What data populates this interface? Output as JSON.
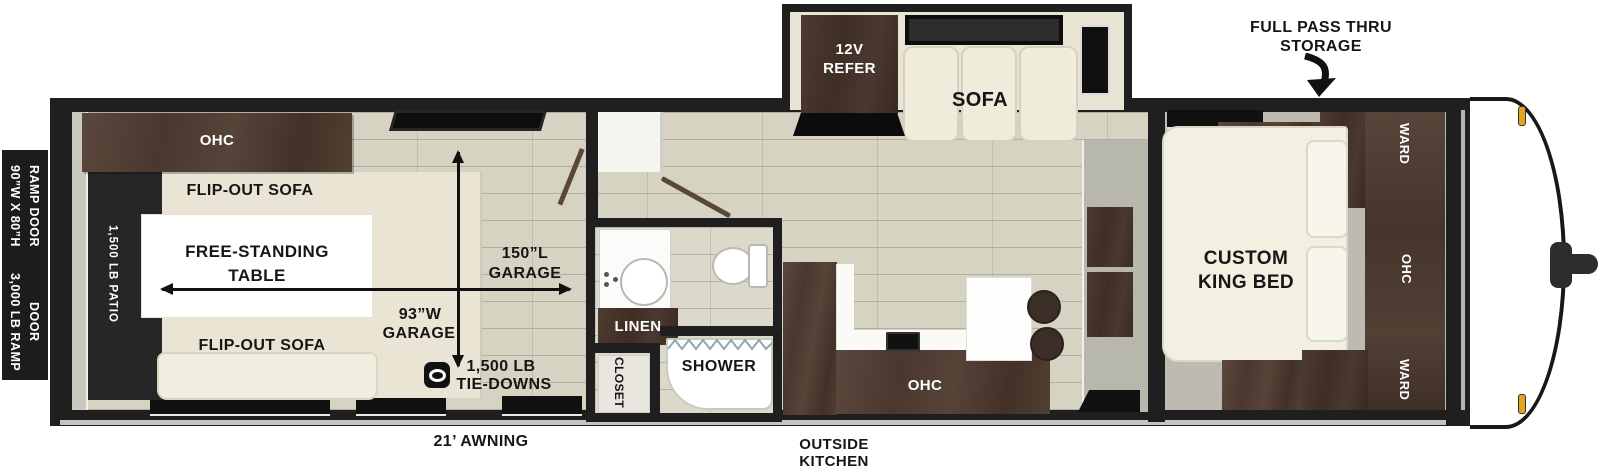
{
  "fp": {
    "rear": {
      "size_l1": "90”W X 80”H",
      "size_l2": "RAMP DOOR",
      "cap_l1": "3,000 LB RAMP",
      "cap_l2": "DOOR"
    },
    "garage": {
      "ohc": "OHC",
      "flip_top": "FLIP-OUT SOFA",
      "flip_bottom": "FLIP-OUT SOFA",
      "patio": "1,500 LB PATIO",
      "table_l1": "FREE-STANDING",
      "table_l2": "TABLE",
      "len_l1": "150”L",
      "len_l2": "GARAGE",
      "wid_l1": "93”W",
      "wid_l2": "GARAGE",
      "tie_l1": "1,500 LB",
      "tie_l2": "TIE-DOWNS"
    },
    "bath": {
      "linen": "LINEN",
      "shower": "SHOWER",
      "closet": "CLOSET"
    },
    "slide": {
      "refer_l1": "12V",
      "refer_l2": "REFER",
      "sofa": "SOFA"
    },
    "kitchen": {
      "ohc": "OHC"
    },
    "bed": {
      "l1": "CUSTOM",
      "l2": "KING BED",
      "ward_top": "WARD",
      "ohc": "OHC",
      "ward_bottom": "WARD"
    },
    "ext": {
      "storage_l1": "FULL PASS THRU",
      "storage_l2": "STORAGE",
      "awning": "21’ AWNING",
      "ok_l1": "OUTSIDE",
      "ok_l2": "KITCHEN"
    },
    "colors": {
      "wall": "#1f1f1f",
      "cabinet_wood": "#4b3a31",
      "floor": "#d7d3c3",
      "patio_black": "#262626",
      "sofa_beige": "#ece8d7",
      "marker_amber": "#e0a71e"
    }
  }
}
